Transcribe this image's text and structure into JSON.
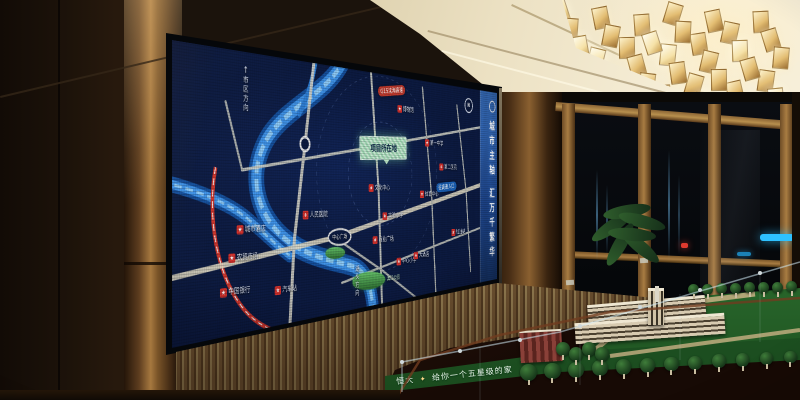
{
  "screen": {
    "sidebar": {
      "slogan": "城市主轴 汇万千繁华",
      "bg_top": "#3a74c4",
      "bg_bottom": "#163567"
    },
    "map": {
      "background": "#0c1a40",
      "river_color": "#3f93e8",
      "road_color": "#d8d4c2",
      "project_marker": {
        "label": "项目所在地"
      },
      "compass": {
        "label": "N"
      },
      "junction": {
        "label": "中心广场"
      },
      "direction_signs": [
        {
          "id": "north-road",
          "arrow": "↑",
          "label": "市区方向"
        },
        {
          "id": "river-south",
          "arrow": "",
          "label": "湖头方向"
        }
      ],
      "route_pills": [
        {
          "label": "G15沈海高速",
          "bg": "#c0392b",
          "x": 362,
          "y": 20,
          "rot": -7
        },
        {
          "label": "往高速入口",
          "bg": "#1b62b8",
          "x": 488,
          "y": 144,
          "rot": -4
        }
      ],
      "parks": [
        {
          "label": "滨江公园",
          "x": 282,
          "y": 252,
          "w": 66,
          "h": 22
        },
        {
          "label": "",
          "x": 232,
          "y": 218,
          "w": 36,
          "h": 14
        }
      ],
      "pois": [
        {
          "label": "人民医院",
          "x": 214,
          "y": 178
        },
        {
          "label": "城市酒店",
          "x": 110,
          "y": 192
        },
        {
          "label": "农贸市场",
          "x": 98,
          "y": 222
        },
        {
          "label": "中国银行",
          "x": 86,
          "y": 258
        },
        {
          "label": "汽车站",
          "x": 164,
          "y": 262
        },
        {
          "label": "博物馆",
          "x": 392,
          "y": 42
        },
        {
          "label": "第一中学",
          "x": 458,
          "y": 84
        },
        {
          "label": "第二医院",
          "x": 492,
          "y": 116
        },
        {
          "label": "文化中心",
          "x": 336,
          "y": 146
        },
        {
          "label": "体育中心",
          "x": 446,
          "y": 154
        },
        {
          "label": "实验小学",
          "x": 364,
          "y": 182
        },
        {
          "label": "商业广场",
          "x": 344,
          "y": 212
        },
        {
          "label": "中心小学",
          "x": 394,
          "y": 242
        },
        {
          "label": "大酒店",
          "x": 428,
          "y": 236
        },
        {
          "label": "加油站",
          "x": 518,
          "y": 208
        }
      ]
    }
  },
  "model_table": {
    "brand": "恒大",
    "slogan": "给你一个五星级的家",
    "lawn_color": "#2f7a33",
    "front_trees": 12,
    "back_trees": 8,
    "left_trees": 4
  },
  "chandelier": {
    "cubes": 38,
    "gold": "#e3bd72"
  },
  "room": {
    "ceiling_color": "#efe4c8",
    "wall_color": "#1b130c",
    "gold_panel_color": "#c9ad72"
  }
}
